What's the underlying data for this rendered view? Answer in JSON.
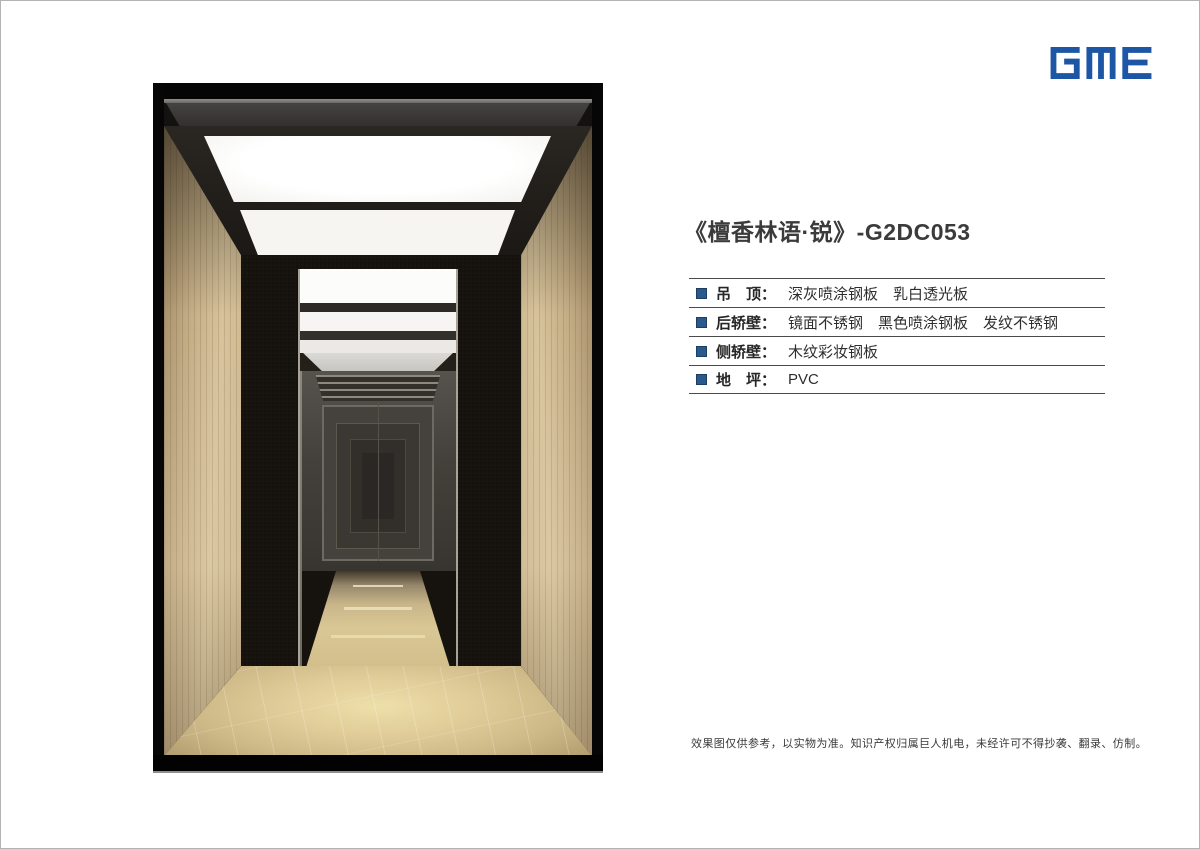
{
  "page": {
    "background": "#ffffff",
    "border_color": "#b3b3b3"
  },
  "brand": {
    "logo_text": "GME",
    "logo_color": "#1d56a4"
  },
  "product": {
    "title": "《檀香林语·锐》-G2DC053"
  },
  "specs": {
    "bullet_color": "#2a5a8c",
    "colon": "：",
    "rows": [
      {
        "label": "吊　顶",
        "value": "深灰喷涂钢板　乳白透光板"
      },
      {
        "label": "后轿壁",
        "value": "镜面不锈钢　黑色喷涂钢板　发纹不锈钢"
      },
      {
        "label": "侧轿壁",
        "value": "木纹彩妆钢板"
      },
      {
        "label": "地　坪",
        "value": "PVC"
      }
    ]
  },
  "footer": {
    "disclaimer": "效果图仅供参考，以实物为准。知识产权归属巨人机电，未经许可不得抄袭、翻录、仿制。"
  },
  "render": {
    "subject": "elevator-car-interior",
    "colors": {
      "wood_wall": "#cdb88f",
      "marble_floor": "#ddc795",
      "ceiling": "#221f1b",
      "light_panel": "#fdfdfd",
      "black_sprayed_panel": "#17130f",
      "mirror_trim": "#a9a296"
    }
  }
}
